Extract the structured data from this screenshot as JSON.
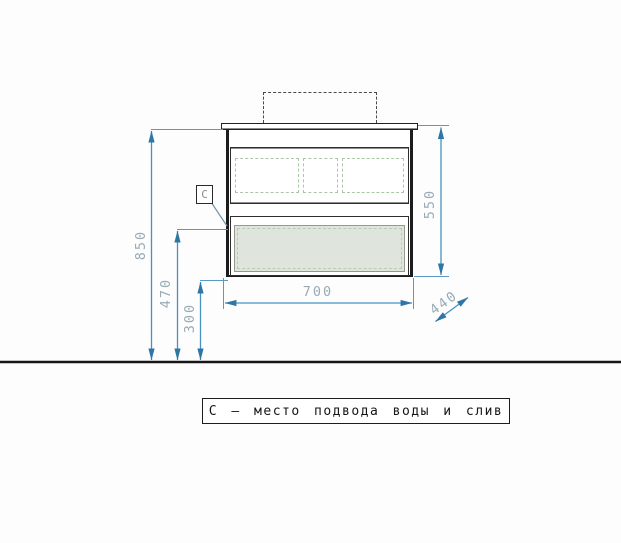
{
  "drawing": {
    "point_label": "C",
    "legend": {
      "text": "С — место подвода воды и слив"
    },
    "dimensions": {
      "floor_to_countertop": "850",
      "floor_to_water_point": "470",
      "floor_to_cabinet_bottom": "300",
      "cabinet_height": "550",
      "cabinet_width": "700",
      "cabinet_depth": "440"
    },
    "colors": {
      "dimension_line": "#4792c2",
      "dimension_arrow": "#2f76a6",
      "dimension_text": "#98abb6",
      "cabinet_outline": "#1c1c1c",
      "hidden_edge_green": "#a9c7a4",
      "drawer_panel_fill": "#dfe4dd",
      "sink_outline_dash": "#4a4a4a",
      "floor_line": "#161616",
      "leader_line": "#7096ab"
    }
  }
}
